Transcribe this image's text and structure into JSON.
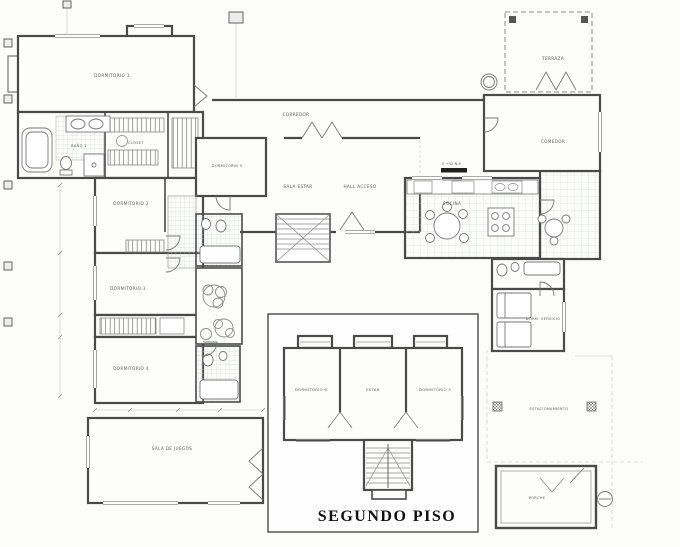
{
  "drawing": {
    "kind": "architectural floor plan"
  },
  "rooms": {
    "dormitorio1": "DORMITORIO 1",
    "bano1": "BAÑO 1",
    "closet": "CLOSET",
    "dormitorio2": "DORMITORIO 2",
    "dormitorio3": "DORMITORIO 3",
    "dormitorio4": "DORMITORIO 4",
    "dormitorio5": "DORMITORIO 5",
    "sala_de_juegos": "SALA DE JUEGOS",
    "corredor": "CORREDOR",
    "sala_estar": "SALA ESTAR",
    "hall_acceso": "HALL ACCESO",
    "cocina": "COCINA",
    "comedor": "COMEDOR",
    "terraza": "TERRAZA",
    "dorm_servicio": "DORM. SERVICIO",
    "estacionamiento": "ESTACIONAMIENTO",
    "porche": "PORCHE"
  },
  "inset": {
    "title": "SEGUNDO PISO",
    "rooms": {
      "dormitorio6": "DORMITORIO 6",
      "estar": "ESTAR",
      "dormitorio5": "DORMITORIO 5"
    }
  },
  "annotations": {
    "elevation_note": "E +42 N.P."
  }
}
